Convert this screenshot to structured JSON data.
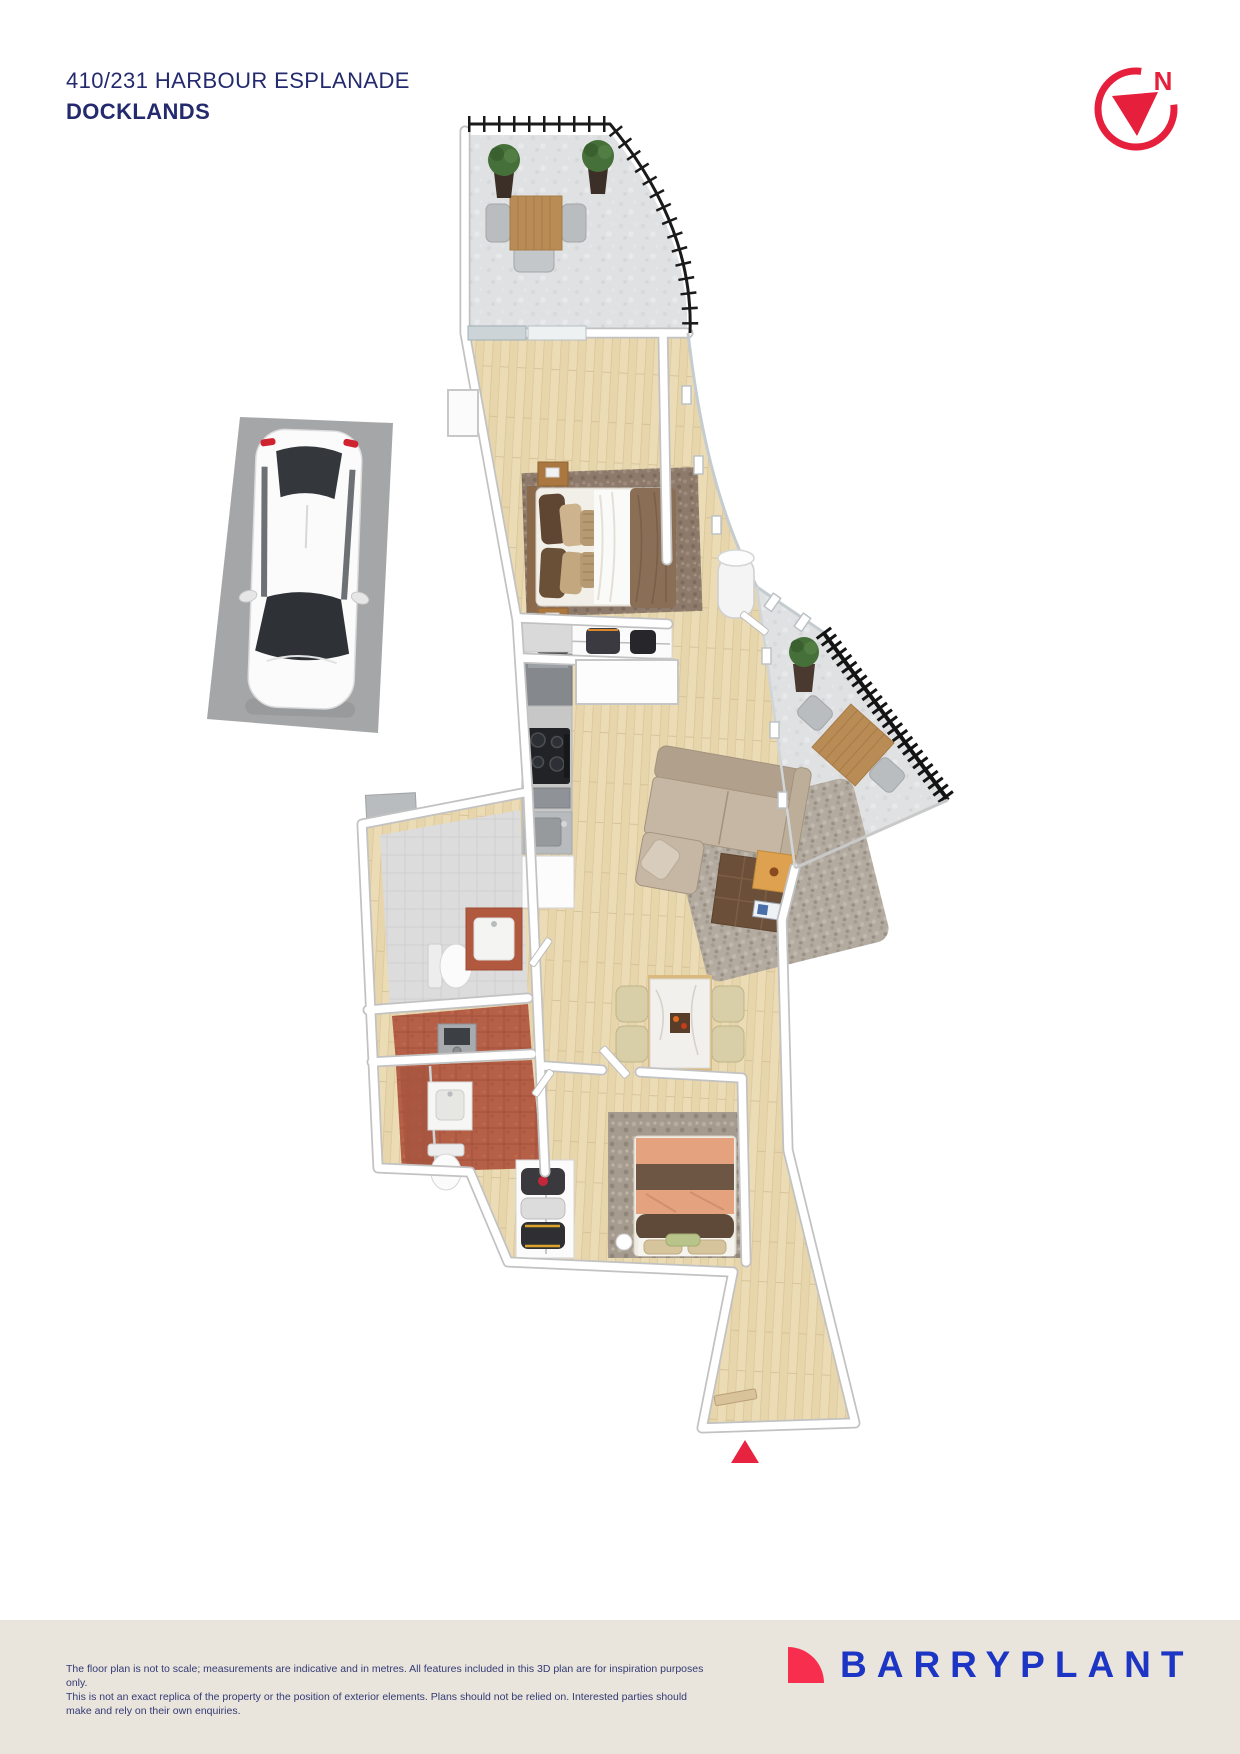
{
  "header": {
    "address": "410/231 HARBOUR ESPLANADE",
    "suburb": "DOCKLANDS"
  },
  "north_indicator": {
    "label": "N"
  },
  "footer": {
    "disclaimer_line1": "The floor plan is not to scale; measurements are indicative and in metres. All features included in this 3D plan are for inspiration purposes only.",
    "disclaimer_line2": "This is not an exact replica of the property or the position of exterior elements. Plans should not be relied on. Interested parties should make and rely on their own enquiries.",
    "brand_name": "BARRYPLANT"
  },
  "colors": {
    "header_text": "#232a6e",
    "disclaimer_text": "#333a75",
    "north_red": "#e6203c",
    "footer_bg": "#e9e5dc",
    "brand_blue": "#1c35c4",
    "brand_red": "#f72e4e",
    "entry_arrow": "#e8233f",
    "wall_white": "#ffffff",
    "wall_edge": "#c2c2c2",
    "wood_floor": "#ecdcb6",
    "concrete_floor": "#dfe1e2",
    "railing_black": "#1a1a1a",
    "terracotta_tile": "#b45f46",
    "gray_tile": "#dcdcdc",
    "sofa_beige": "#c6b7a4",
    "car_pad_gray": "#a5a6a8"
  }
}
